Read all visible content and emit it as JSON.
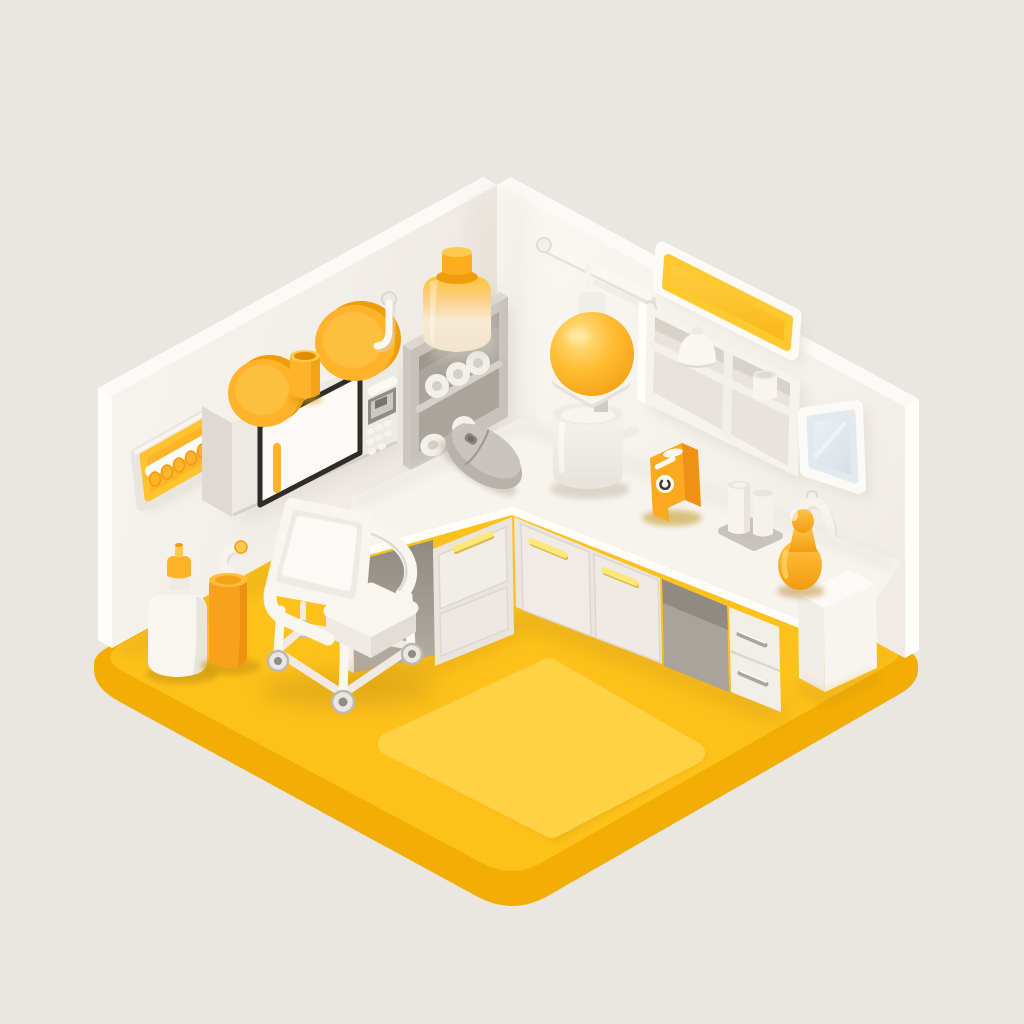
{
  "meta": {
    "title": "Isometric miniature room in yellow and white — clinic corner with counter, microwave, shelves and rolling chair",
    "style": "soft 3D isometric illustration, no visible text"
  },
  "palette": {
    "bg": "#EAE6E2",
    "floorTop": "#FEC11C",
    "floorSide": "#F3AE06",
    "floorMat": "#FFD245",
    "wallCap": "#FCFAF7",
    "wallEdge": "#FFFEFC",
    "accent": "#FFB32A",
    "accentDeep": "#F09D0B",
    "accentLight": "#FFC94F",
    "accentDark": "#E08E00",
    "signYellow": "#FFC82E",
    "paleHandle": "#FFE678",
    "white1": "#F9F6F1",
    "white2": "#EFEBE4",
    "white3": "#E2DED7",
    "grayUnit": "#C6C2BB",
    "grayDark": "#A9A59D",
    "grayLight": "#DDD9D2",
    "mouseBody": "#B7B3AC",
    "mouseTop": "#C9C5BE",
    "doorOutline": "#2E2C29",
    "boxFront": "#FBA91F",
    "boxSide": "#EE9114",
    "boxTop": "#FFC145",
    "orange": "#F9A11C",
    "cream": "#F7EFDF",
    "silver": "#A9A59F"
  },
  "objects": [
    {
      "id": "floor-slab",
      "label": "yellow floor slab"
    },
    {
      "id": "floor-mat",
      "label": "raised yellow floor mat"
    },
    {
      "id": "left-wall",
      "label": "white left wall"
    },
    {
      "id": "right-wall",
      "label": "white right wall"
    },
    {
      "id": "hook-rack",
      "label": "yellow wall hook rack with five pegs"
    },
    {
      "id": "wall-plates",
      "label": "two yellow plates on shelf"
    },
    {
      "id": "yellow-cup",
      "label": "yellow cup on shelf"
    },
    {
      "id": "microwave",
      "label": "wall-mounted microwave oven with yellow handle"
    },
    {
      "id": "wall-hook",
      "label": "white wall hook"
    },
    {
      "id": "supply-shelf",
      "label": "gray supply shelf with paper rolls"
    },
    {
      "id": "storage-jar",
      "label": "cream storage jar with yellow lid"
    },
    {
      "id": "towel-rail",
      "label": "white towel rail"
    },
    {
      "id": "pendant-lamp",
      "label": "yellow sphere pendant lamp"
    },
    {
      "id": "instrument-tray",
      "label": "white instrument tray"
    },
    {
      "id": "white-pot",
      "label": "white pot with handle"
    },
    {
      "id": "wall-sign",
      "label": "blank yellow wall sign"
    },
    {
      "id": "wall-shelf-unit",
      "label": "white wall shelf with dome jar and cup"
    },
    {
      "id": "mirror",
      "label": "wall mirror"
    },
    {
      "id": "headphones",
      "label": "white headphones on hook"
    },
    {
      "id": "counter",
      "label": "L-shaped white countertop"
    },
    {
      "id": "left-drawer-unit",
      "label": "drawer unit with pale yellow handle"
    },
    {
      "id": "cabinet-doors",
      "label": "two cabinet doors with pale yellow handles"
    },
    {
      "id": "under-counter-recess",
      "label": "open recess under counter"
    },
    {
      "id": "silver-drawer-unit",
      "label": "drawer unit with silver handles"
    },
    {
      "id": "side-cabinet",
      "label": "white side cabinet"
    },
    {
      "id": "computer-mouse",
      "label": "gray computer mouse"
    },
    {
      "id": "dispenser-box",
      "label": "yellow dispenser box with dial"
    },
    {
      "id": "counter-bottles",
      "label": "two white bottles on gray mat"
    },
    {
      "id": "figurine",
      "label": "yellow figurine"
    },
    {
      "id": "squeeze-bottle",
      "label": "white squeeze bottle with yellow cap"
    },
    {
      "id": "waste-canister",
      "label": "yellow canister with bent tube"
    },
    {
      "id": "rolling-chair",
      "label": "white rolling chair with casters"
    }
  ]
}
